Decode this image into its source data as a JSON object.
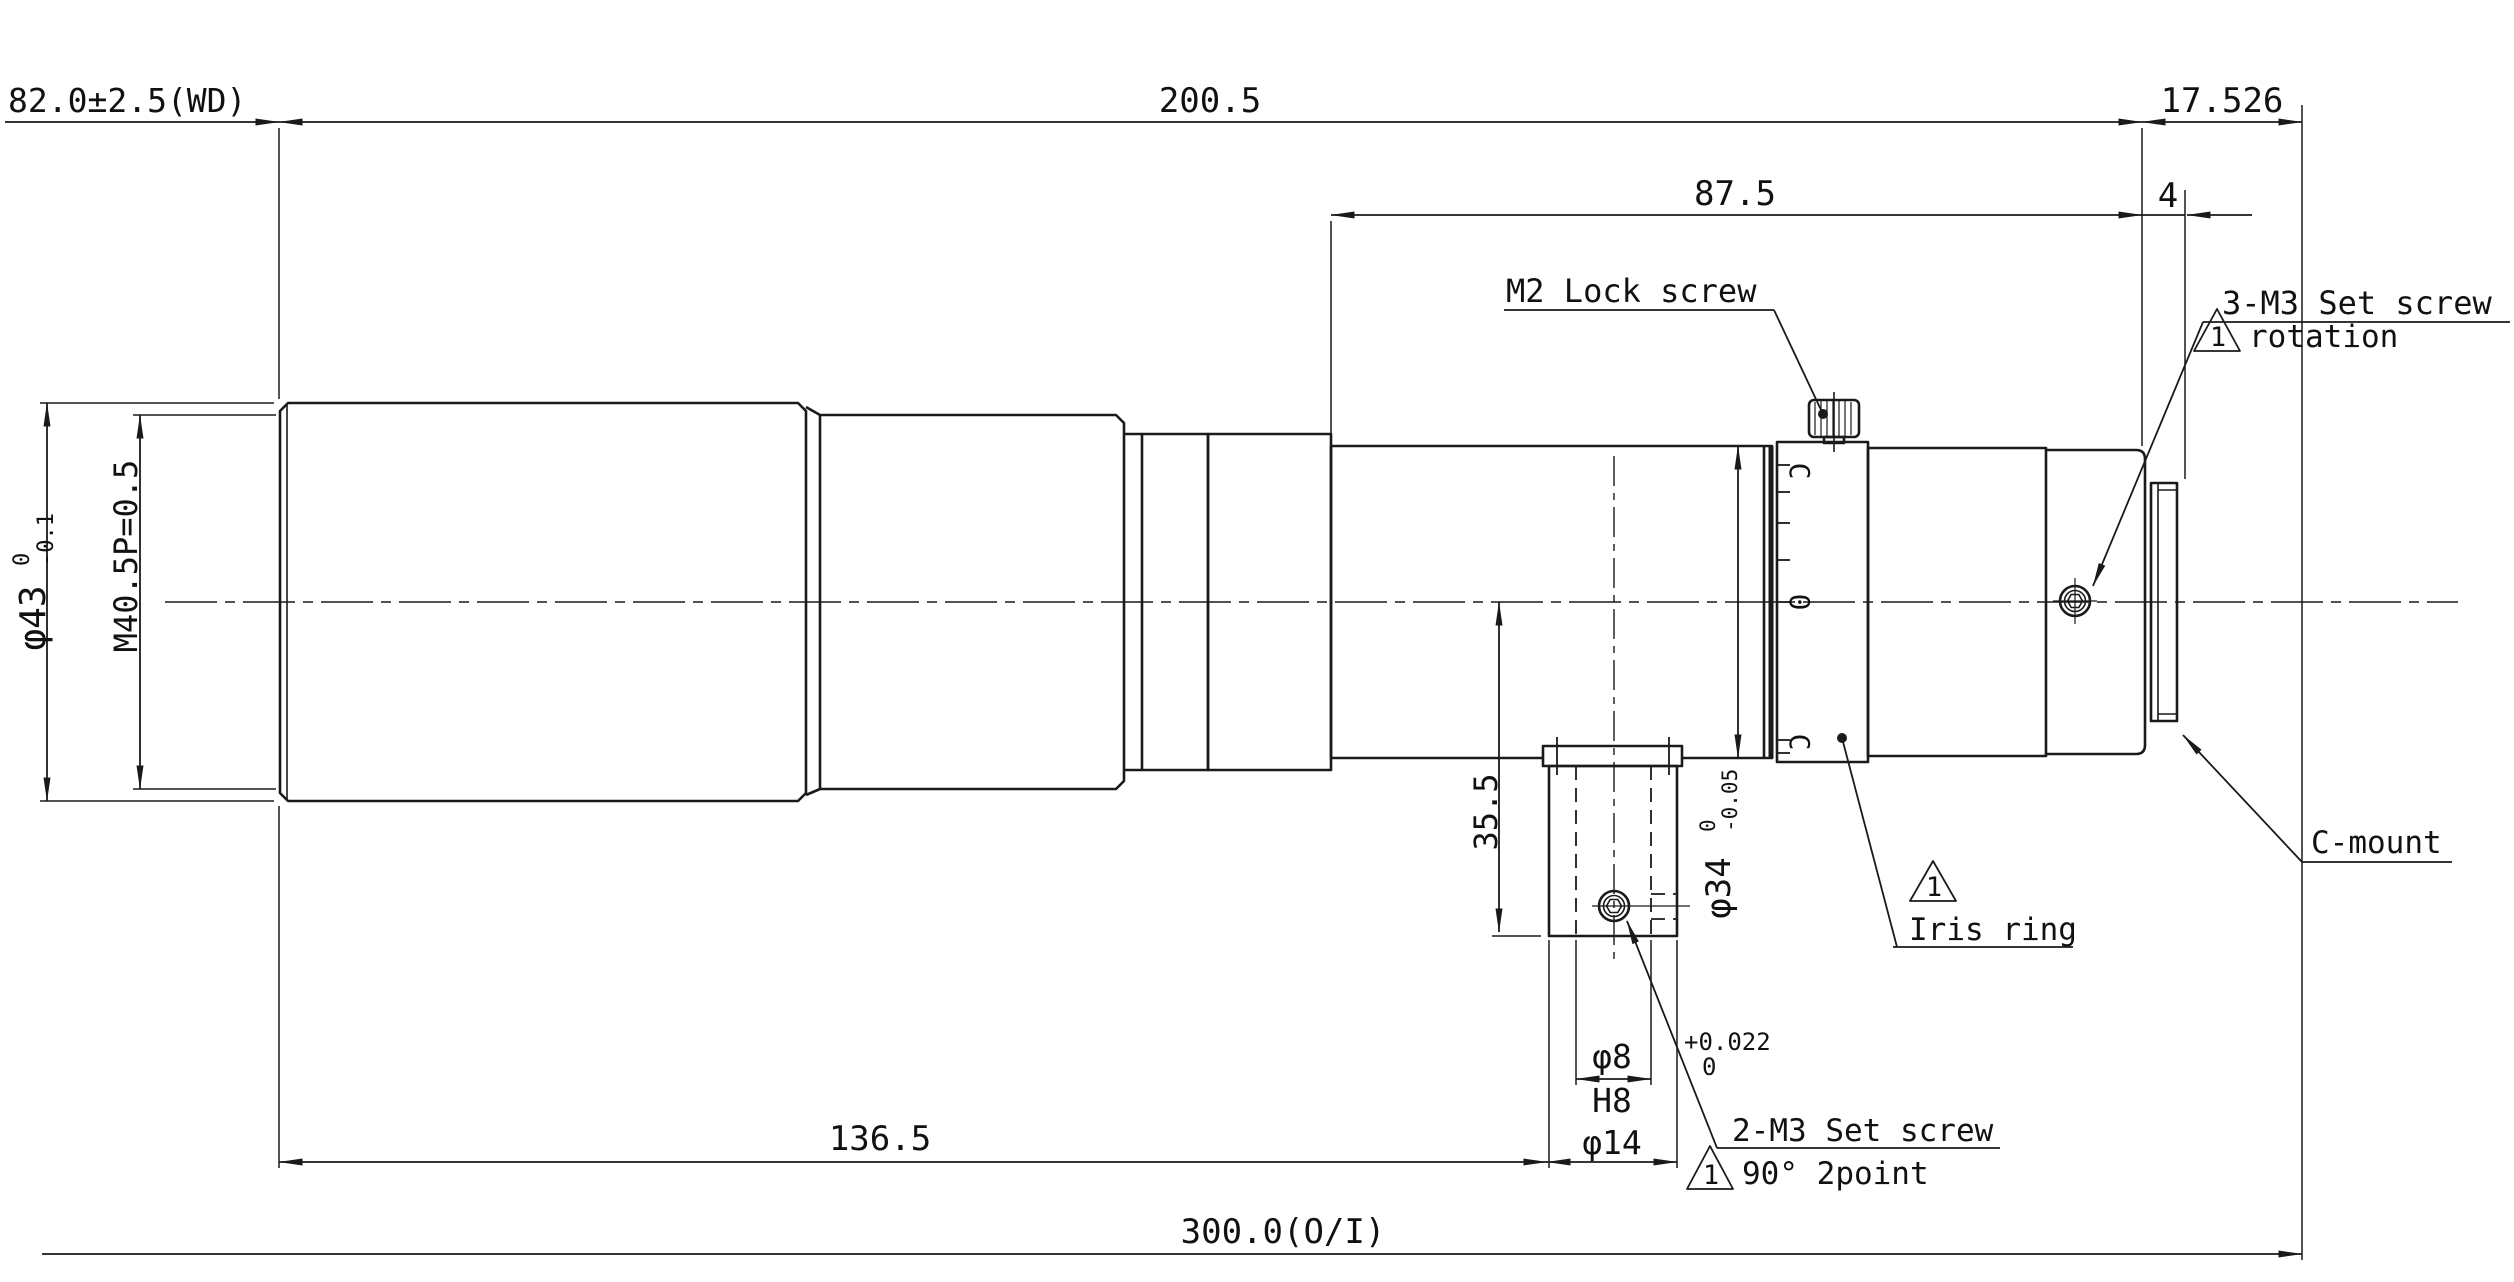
{
  "drawing": {
    "colors": {
      "line": "#1a1a1a",
      "background": "#ffffff"
    },
    "dimensions": {
      "working_distance": "82.0±2.5(WD)",
      "lens_length": "200.5",
      "flange_back": "17.526",
      "rear_section_length": "87.5",
      "cmount_thread_length": "4",
      "front_to_foot": "136.5",
      "object_to_image": "300.0(O/I)",
      "front_diameter": {
        "value": "φ43",
        "tol_upper": "0",
        "tol_lower": "-0.1"
      },
      "front_thread": "M40.5P=0.5",
      "foot_height": "35.5",
      "tube_diameter": {
        "value": "φ34",
        "tol_upper": "0",
        "tol_lower": "-0.05"
      },
      "foot_hole": {
        "value": "φ8",
        "tol_upper": "+0.022",
        "tol_lower": "0",
        "fit": "H8"
      },
      "foot_boss_diameter": "φ14"
    },
    "labels": {
      "lock_screw": "M2 Lock screw",
      "set_screw_rear": "3-M3 Set screw",
      "set_screw_rear_note": "rotation",
      "iris_ring": "Iris ring",
      "c_mount": "C-mount",
      "set_screw_foot": "2-M3 Set screw",
      "set_screw_foot_note": "90° 2point",
      "note_number": "1"
    },
    "iris_scale": {
      "top": "C",
      "middle": "0",
      "bottom": "C"
    }
  }
}
